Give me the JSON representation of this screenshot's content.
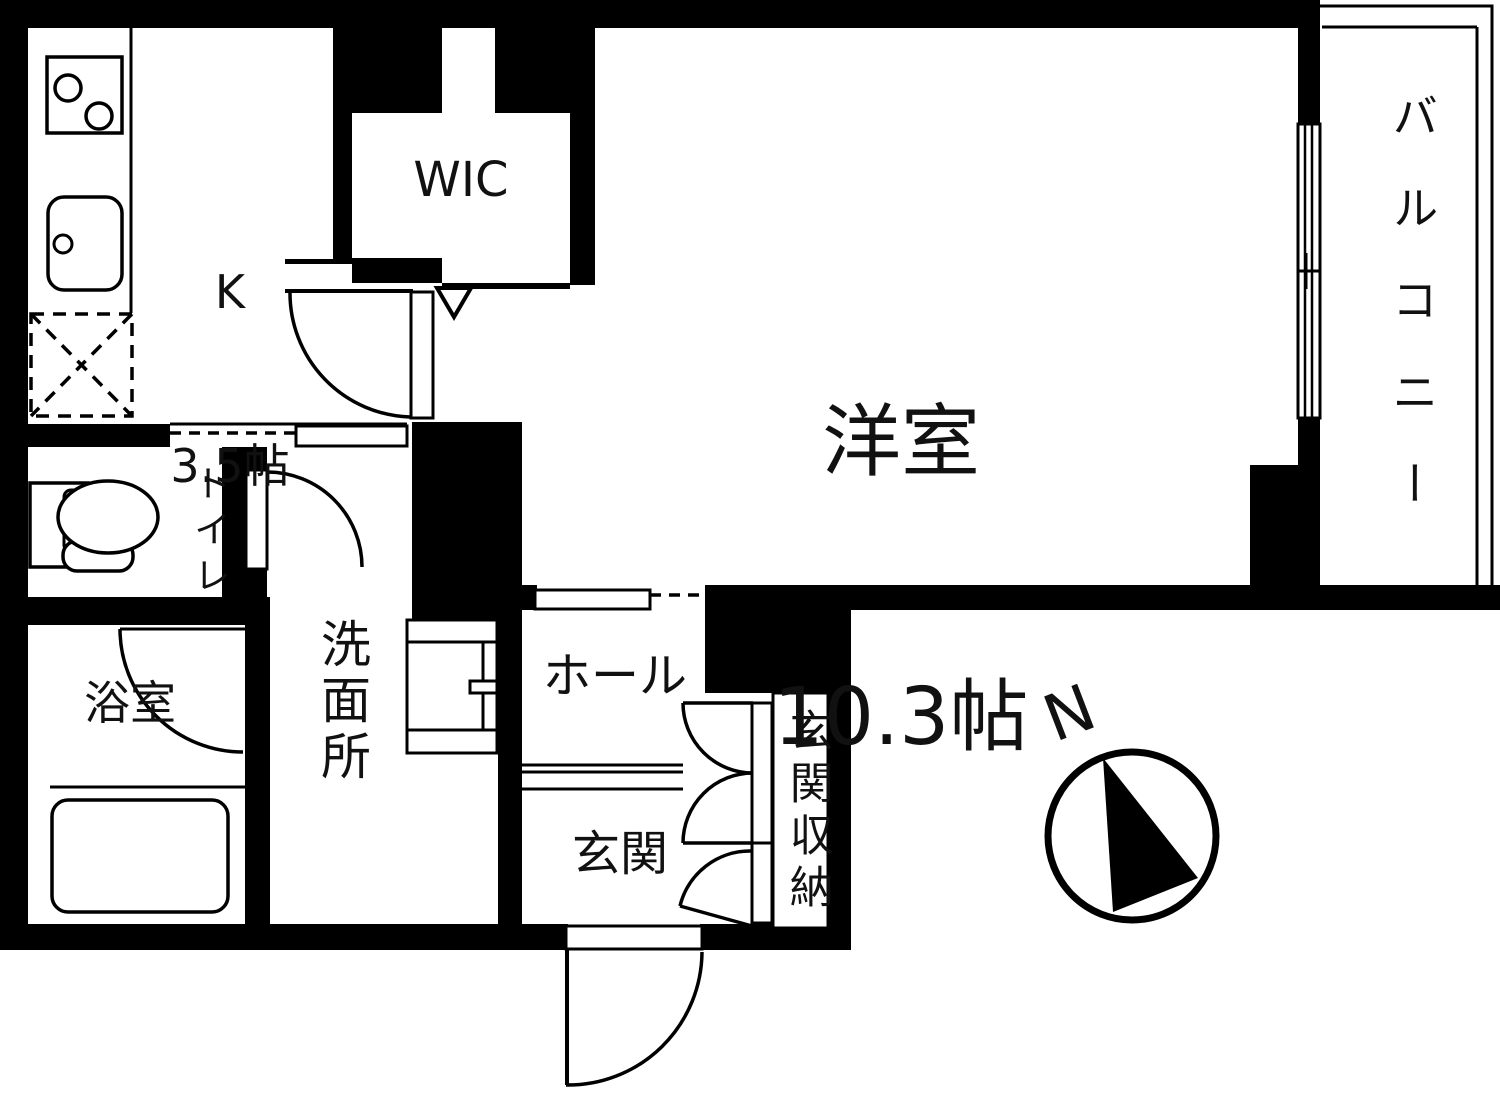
{
  "plan": {
    "type": "floor-plan",
    "rooms": {
      "kitchen": {
        "label": "K",
        "size": "3.5帖"
      },
      "wic": {
        "label": "WIC"
      },
      "western_room": {
        "label": "洋室",
        "size": "10.3帖"
      },
      "balcony": {
        "label": "バルコニー"
      },
      "toilet": {
        "label": "トイレ"
      },
      "bathroom": {
        "label": "浴室"
      },
      "washroom": {
        "label": "洗面所"
      },
      "hall": {
        "label": "ホール"
      },
      "entrance": {
        "label": "玄関"
      },
      "entrance_storage": {
        "label": "玄関収納"
      }
    },
    "compass": {
      "label": "N"
    },
    "colors": {
      "wall": "#000000",
      "background": "#ffffff",
      "line": "#000000",
      "text": "#111111"
    }
  }
}
